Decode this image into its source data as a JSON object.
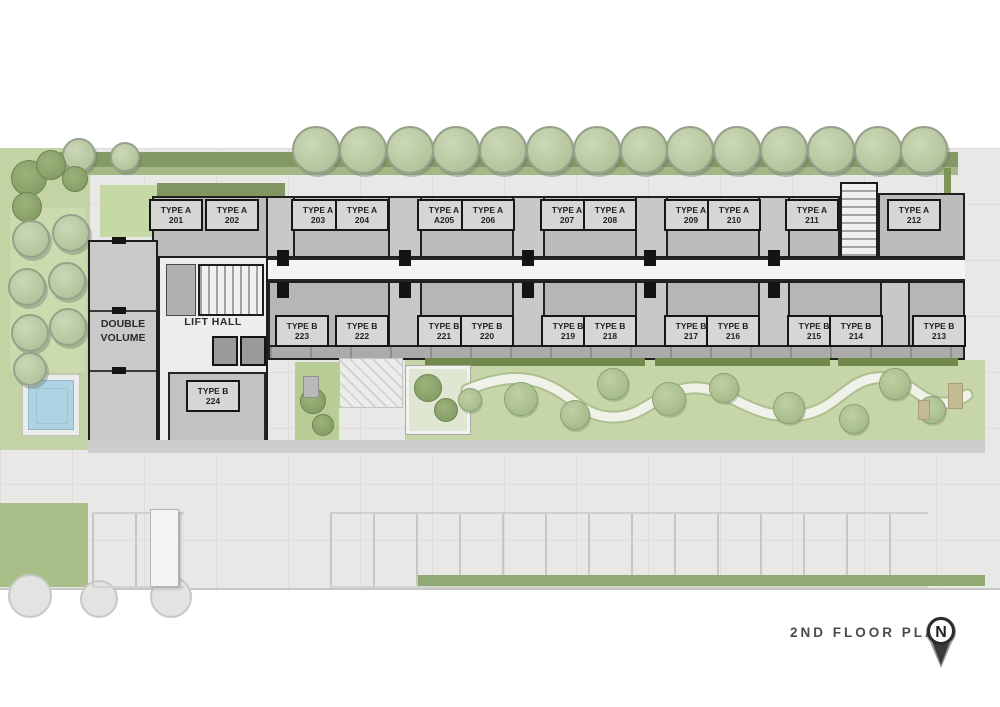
{
  "plan": {
    "name": "residential floor plan",
    "labels": {
      "lift_hall": "LIFT HALL",
      "double_volume_line1": "DOUBLE",
      "double_volume_line2": "VOLUME"
    },
    "units": {
      "type_a_row": [
        {
          "type": "TYPE A",
          "number": "201"
        },
        {
          "type": "TYPE A",
          "number": "202"
        },
        {
          "type": "TYPE A",
          "number": "203"
        },
        {
          "type": "TYPE A",
          "number": "204"
        },
        {
          "type": "TYPE A",
          "number": "A205"
        },
        {
          "type": "TYPE A",
          "number": "206"
        },
        {
          "type": "TYPE A",
          "number": "207"
        },
        {
          "type": "TYPE A",
          "number": "208"
        },
        {
          "type": "TYPE A",
          "number": "209"
        },
        {
          "type": "TYPE A",
          "number": "210"
        },
        {
          "type": "TYPE A",
          "number": "211"
        },
        {
          "type": "TYPE A",
          "number": "212"
        }
      ],
      "type_b_row": [
        {
          "type": "TYPE B",
          "number": "223"
        },
        {
          "type": "TYPE B",
          "number": "222"
        },
        {
          "type": "TYPE B",
          "number": "221"
        },
        {
          "type": "TYPE B",
          "number": "220"
        },
        {
          "type": "TYPE B",
          "number": "219"
        },
        {
          "type": "TYPE B",
          "number": "218"
        },
        {
          "type": "TYPE B",
          "number": "217"
        },
        {
          "type": "TYPE B",
          "number": "216"
        },
        {
          "type": "TYPE B",
          "number": "215"
        },
        {
          "type": "TYPE B",
          "number": "214"
        },
        {
          "type": "TYPE B",
          "number": "213"
        }
      ],
      "type_b_lobby": {
        "type": "TYPE B",
        "number": "224"
      }
    }
  },
  "footer": {
    "title": "2ND FLOOR PLAN",
    "north_marker": "N"
  },
  "colors": {
    "paving": "#e8e8e6",
    "building_gray": "#b9b9b7",
    "wall_dark": "#1d1d1b",
    "corridor": "#f4f4f2",
    "garden_light": "#c6d6a8",
    "hedge_dark": "#72894e",
    "hedge": "#849a64",
    "tree_sage": "#b3c49a",
    "pool_blue": "#afd3e2",
    "path_white": "#f0f2ea",
    "title_text": "#4b4b4b"
  }
}
